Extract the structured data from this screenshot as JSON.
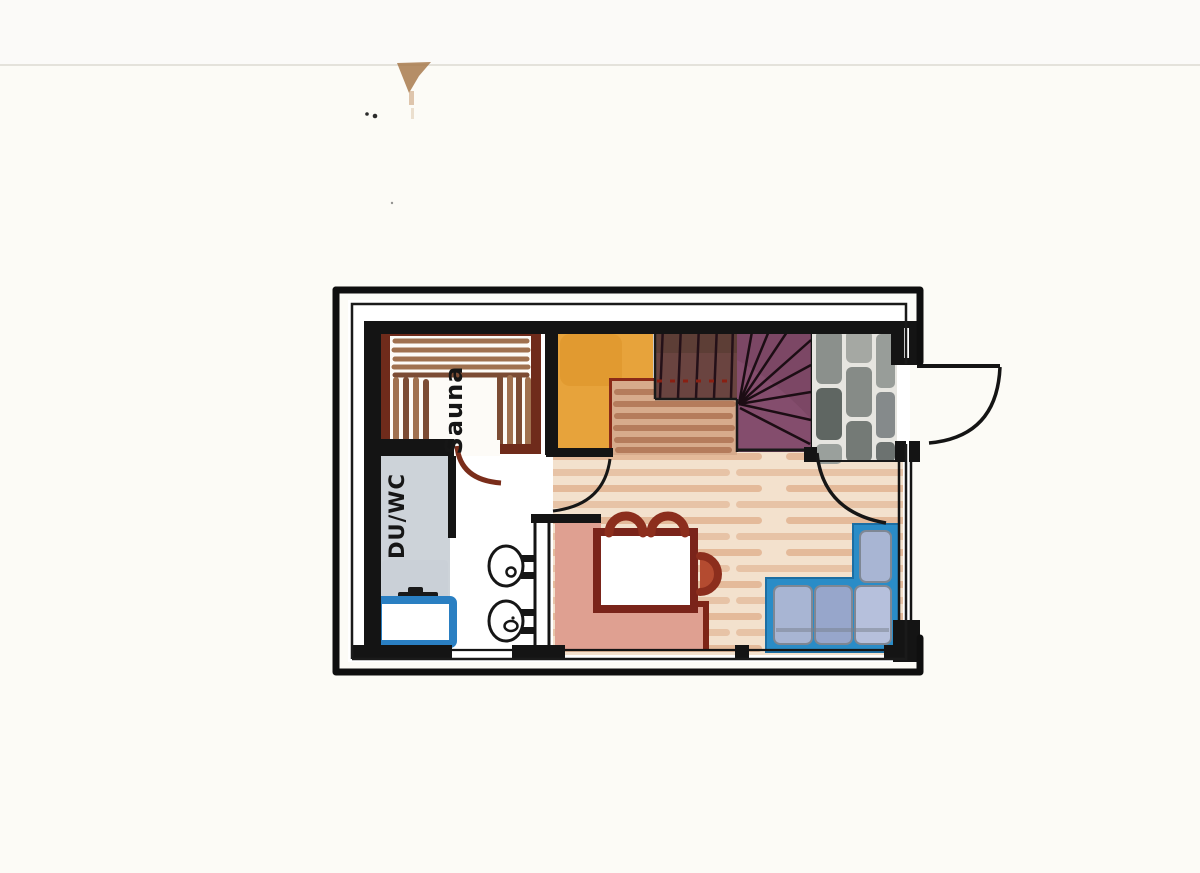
{
  "document": {
    "kind": "hand-drawn watercolor floor plan, scanned on white paper"
  },
  "labels": {
    "sauna": "Sauna",
    "du_wc": "DU/WC"
  },
  "colors": {
    "paper": "#fcfbf6",
    "ink": "#141414",
    "sauna_wall": "#6f2b1b",
    "bench_slat": "#a0714f",
    "bench_slat_dark": "#7c4c34",
    "landing_orange": "#e7a33b",
    "tread_base": "#d7ab8c",
    "tread_stroke": "#b57c5c",
    "stair_dark": "#6a4440",
    "stair_purple": "#7c4765",
    "stone_gray": "#8b908c",
    "stone_bg": "#e6e5e0",
    "wood_floor": "#f3e1cd",
    "wood_stripe": "#e0af8c",
    "bench_pink": "#dfa091",
    "table_maroon": "#7a241a",
    "chair_maroon": "#8c2e1d",
    "chair_fill": "#b44b30",
    "sofa_blue": "#2a8cc7",
    "cushion_blue": "#a8b5d3",
    "cushion_blue_dark": "#97a6cb",
    "cushion_blue_light": "#b6c0dc",
    "basin_blue": "#2a7fc2",
    "wet_gray": "#c9cfd6",
    "smudge_brown": "#a87a4e"
  }
}
